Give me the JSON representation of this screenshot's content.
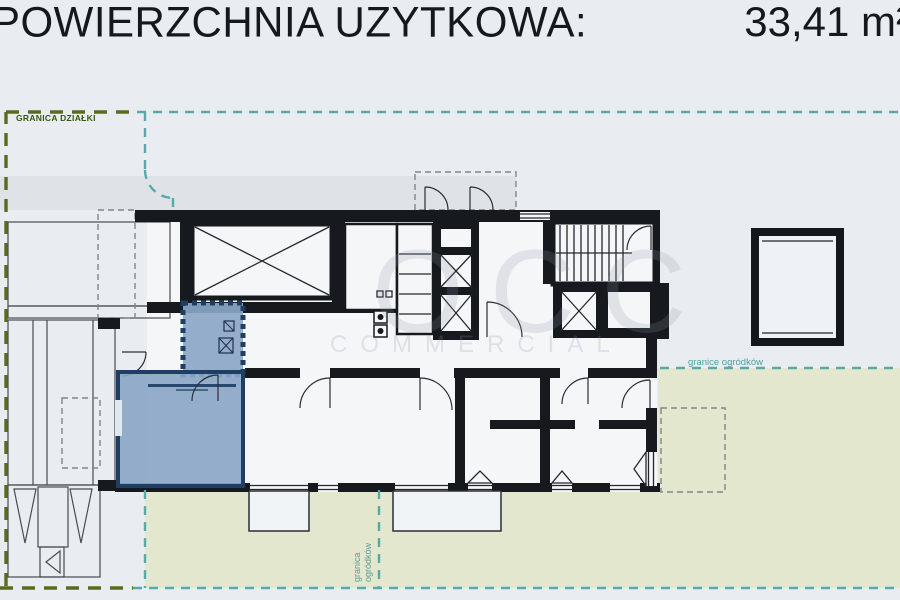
{
  "header": {
    "title": "POWIERZCHNIA UZYTKOWA:",
    "area_value": "33,41 m²"
  },
  "plan": {
    "labels": {
      "plot_boundary": "GRANICA DZIAŁKI",
      "garden_boundary_right": "granice ogródków",
      "garden_boundary_bottom_line1": "granica",
      "garden_boundary_bottom_line2": "ogródków"
    },
    "watermark": {
      "brand": "OCC",
      "word": "COMMERCIAL"
    },
    "colors": {
      "background": "#e9edf2",
      "highlight_fill": "#8aa6c6",
      "highlight_border": "#1e3f63",
      "garden_green": "#e3e7cd",
      "boundary_teal": "#56aaa9",
      "boundary_olive": "#5a6b1e",
      "wall_black": "#16191d",
      "neighbor_gray": "#e2e5e9",
      "band_gray": "#dfe3e7"
    }
  }
}
